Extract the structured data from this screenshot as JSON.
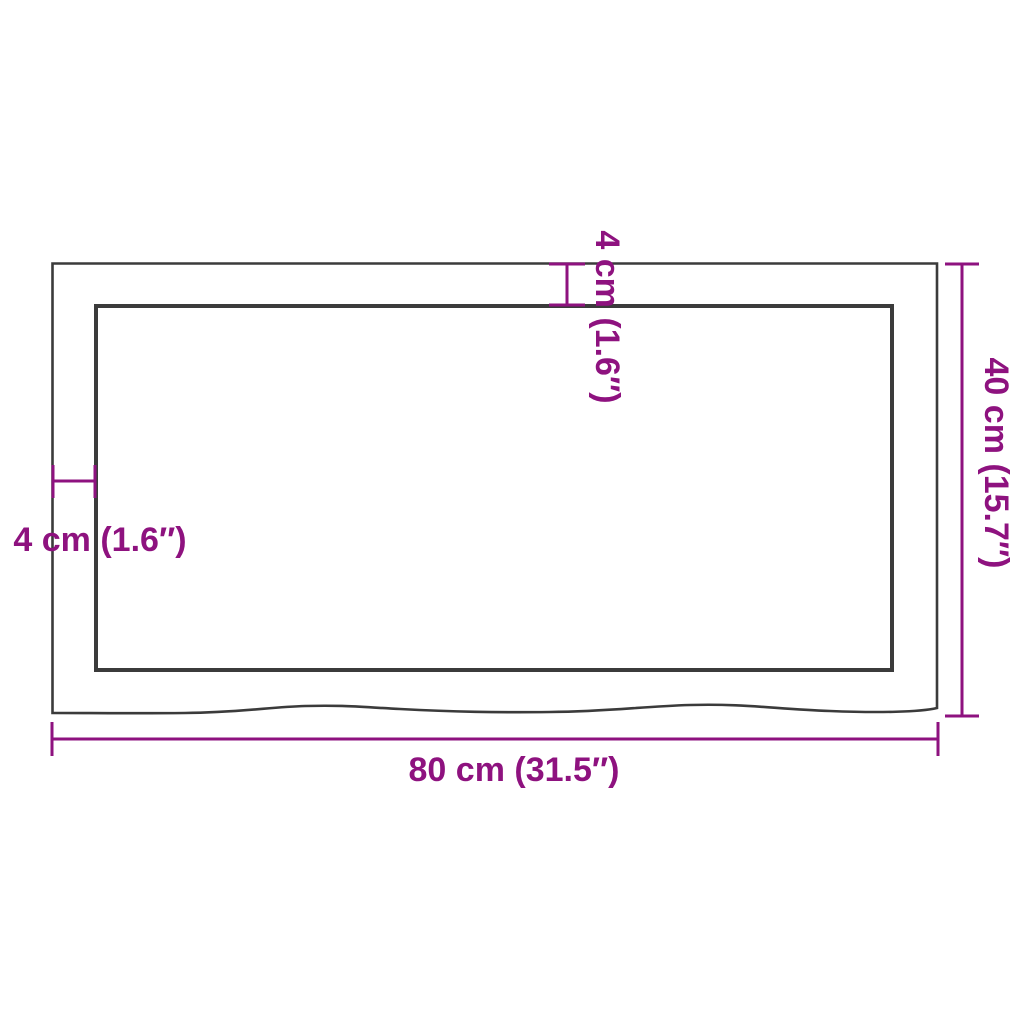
{
  "diagram": {
    "kind": "product-dimension-diagram",
    "subject": "rectangular-panel-top-view-with-live-edge"
  },
  "colors": {
    "dimension": "#8E127F",
    "outline": "#3B3B3B",
    "background": "#FFFFFF"
  },
  "dimensions": {
    "width": {
      "label": "80 cm (31.5″)",
      "position": "bottom"
    },
    "height": {
      "label": "40 cm (15.7″)",
      "position": "right"
    },
    "thickness_top": {
      "label": "4 cm (1.6″)",
      "position": "top"
    },
    "thickness_left": {
      "label": "4 cm (1.6″)",
      "position": "left"
    }
  }
}
